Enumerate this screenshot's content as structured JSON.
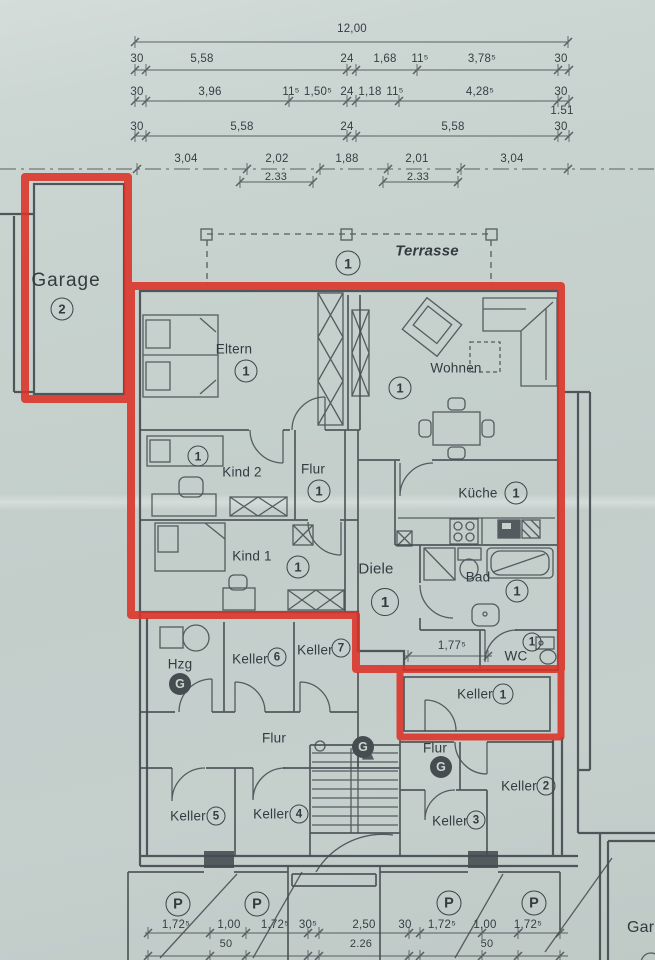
{
  "colors": {
    "paper": "#c6d1ce",
    "ink": "#454c50",
    "red": "#dc3127"
  },
  "dims": {
    "total": "12,00",
    "row2": [
      "30",
      "5,58",
      "24",
      "1,68",
      "11⁵",
      "3,78⁵",
      "30"
    ],
    "row3": [
      "30",
      "3,96",
      "11⁵",
      "1,50⁵",
      "24",
      "1,18",
      "11⁵",
      "4,28⁵",
      "30"
    ],
    "row3_right": "1.51",
    "row4": [
      "30",
      "5,58",
      "24",
      "5,58",
      "30"
    ],
    "row5": [
      "3,04",
      "2,02",
      "1,88",
      "2,01",
      "3,04"
    ],
    "row5_sub": [
      "2.33",
      "2.33"
    ],
    "wc": "1,77⁵",
    "bottom": [
      "1,72⁵",
      "1,00",
      "1,72⁵",
      "30⁵",
      "2,50",
      "30",
      "1,72⁵",
      "1,00",
      "1,72⁵"
    ],
    "bottom_sub": [
      "50",
      "2.26",
      "50"
    ]
  },
  "rooms": {
    "garage": {
      "label": "Garage",
      "num": "2"
    },
    "terrasse": {
      "label": "Terrasse",
      "num": "1"
    },
    "eltern": {
      "label": "Eltern",
      "num": "1"
    },
    "wohnen": {
      "label": "Wohnen",
      "num": "1"
    },
    "kind2": {
      "label": "Kind 2",
      "num": "1"
    },
    "flur_upper": {
      "label": "Flur",
      "num": "1"
    },
    "kueche": {
      "label": "Küche",
      "num": "1"
    },
    "kind1": {
      "label": "Kind 1",
      "num": "1"
    },
    "diele": {
      "label": "Diele",
      "num": "1"
    },
    "bad": {
      "label": "Bad",
      "num": "1"
    },
    "wc": {
      "label": "WC",
      "num": "1"
    },
    "keller1": {
      "label": "Keller",
      "num": "1"
    },
    "hzg": {
      "label": "Hzg",
      "badge": "G"
    },
    "keller6": {
      "label": "Keller",
      "num": "6"
    },
    "keller7": {
      "label": "Keller",
      "num": "7"
    },
    "flur_base_left": {
      "label": "Flur",
      "badge": "G"
    },
    "keller5": {
      "label": "Keller",
      "num": "5"
    },
    "keller4": {
      "label": "Keller",
      "num": "4"
    },
    "flur_base_right": {
      "label": "Flur",
      "badge": "G"
    },
    "keller2": {
      "label": "Keller",
      "num": "2"
    },
    "keller3": {
      "label": "Keller",
      "num": "3"
    },
    "garage_right": {
      "label": "Gar"
    }
  },
  "parking": {
    "badge": "P"
  }
}
